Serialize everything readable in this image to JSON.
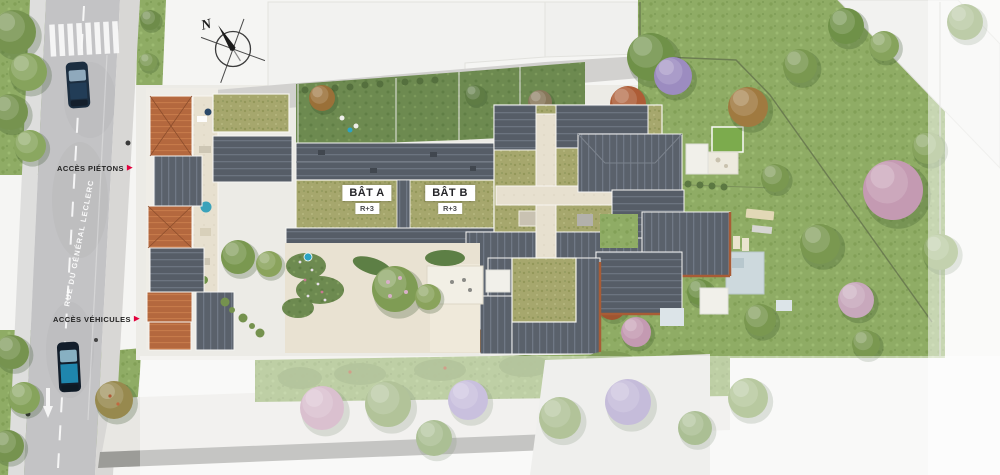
{
  "palette": {
    "accent_red": "#E2003C",
    "roof_slate": "#5A616B",
    "roof_terracotta": "#B4683E",
    "green_roof": "#A6A76D",
    "lawn_green": "#8FAC65",
    "road_gray": "#C3C3C5",
    "paving_beige": "#E9E3D3"
  },
  "compass": {
    "north_label": "N"
  },
  "street": {
    "name": "RUE DU GÉNÉRAL LECLERC"
  },
  "access": {
    "arrow_icon": "▶",
    "pedestrian": {
      "label": "ACCÈS PIÉTONS"
    },
    "vehicles": {
      "label": "ACCÈS VÉHICULES"
    }
  },
  "buildings": [
    {
      "label": "BÂT A",
      "floors": "R+3"
    },
    {
      "label": "BÂT B",
      "floors": "R+3"
    }
  ]
}
